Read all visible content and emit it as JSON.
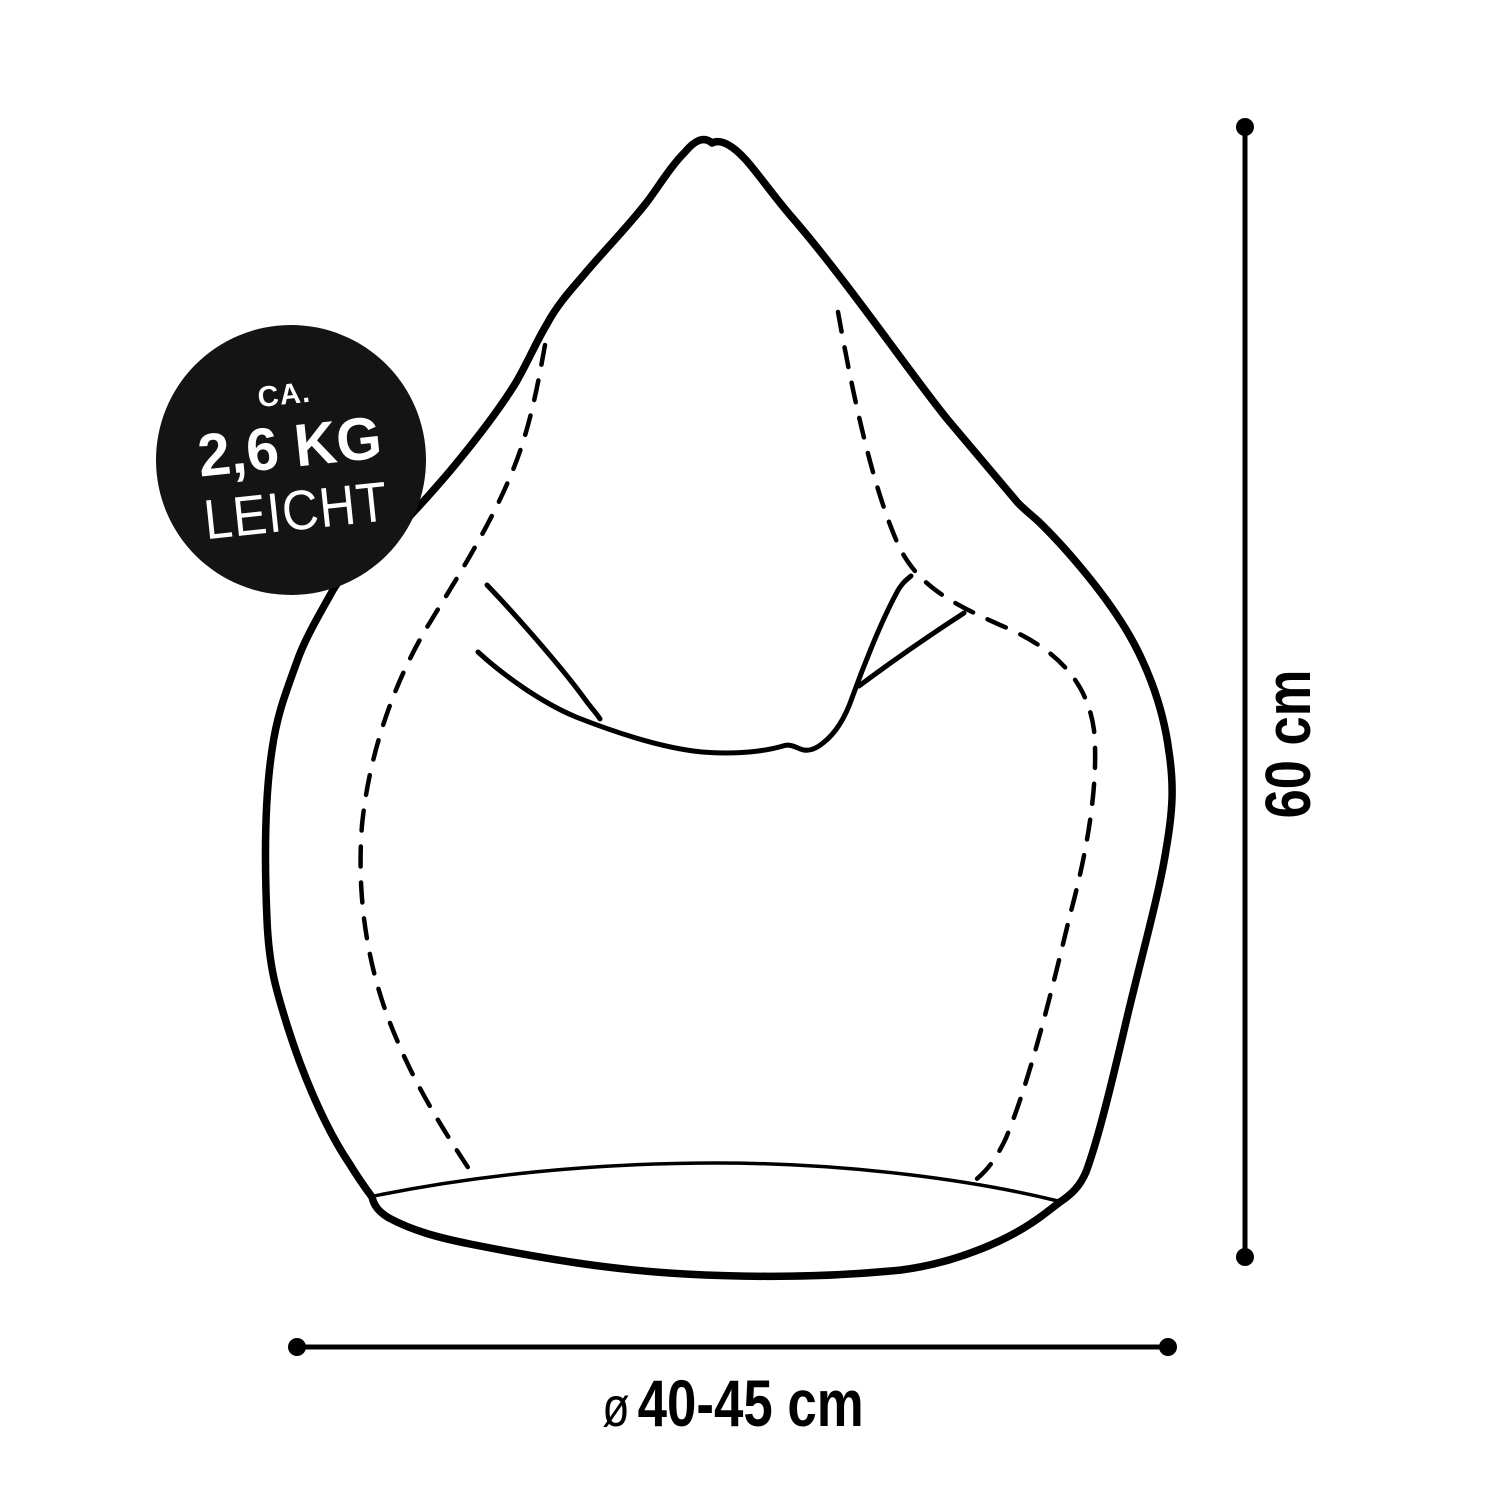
{
  "colors": {
    "ink": "#000000",
    "badge_bg": "#141414",
    "badge_text": "#ffffff",
    "background": "#ffffff"
  },
  "badge": {
    "prefix": "CA.",
    "weight": "2,6 KG",
    "descriptor": "LEICHT"
  },
  "dimensions": {
    "height_label": "60 cm",
    "diameter_symbol": "ø",
    "diameter_value": "40-45 cm"
  }
}
